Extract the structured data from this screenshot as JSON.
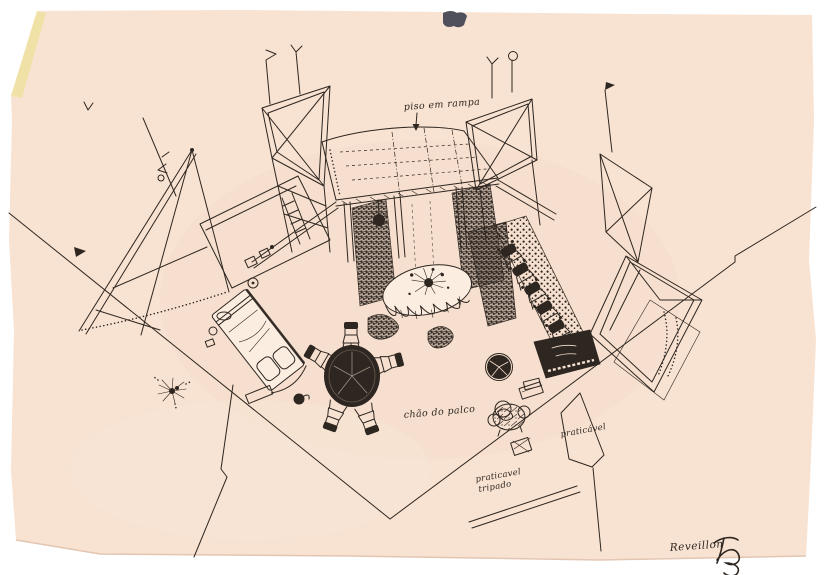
{
  "document": {
    "kind": "scanned ink scenography sketch on aged paper",
    "background_color": "#ffffff",
    "paper_color": "#f8e2d1",
    "aged_edge_color": "#efe0a0",
    "smudge_color": "#50505c",
    "ink_color": "#2e2620"
  },
  "annotations": {
    "ramp_label": "piso em rampa",
    "stage_floor_label": "chão do palco",
    "platform_label": "praticável",
    "platform2_label_line1": "praticavel",
    "platform2_label_line2": "tripado",
    "signature_text": "Reveillon"
  },
  "scene_elements": [
    "fan of tall braced scenery flats",
    "central ramped platform (piso em rampa)",
    "elevated walkway truss with posts",
    "textured panels flanking the opening",
    "banquet table with scalloped tablecloth and floral centerpiece",
    "bed with pillows and bedside objects",
    "round black dining table with chairs",
    "row of ornate chairs along right wall",
    "dark piano with keyboard",
    "round pouf and stuffed armchair",
    "small crates and bench",
    "sparkling floor lamp",
    "stage floor outline and praticável platforms",
    "artist signature monogram"
  ]
}
